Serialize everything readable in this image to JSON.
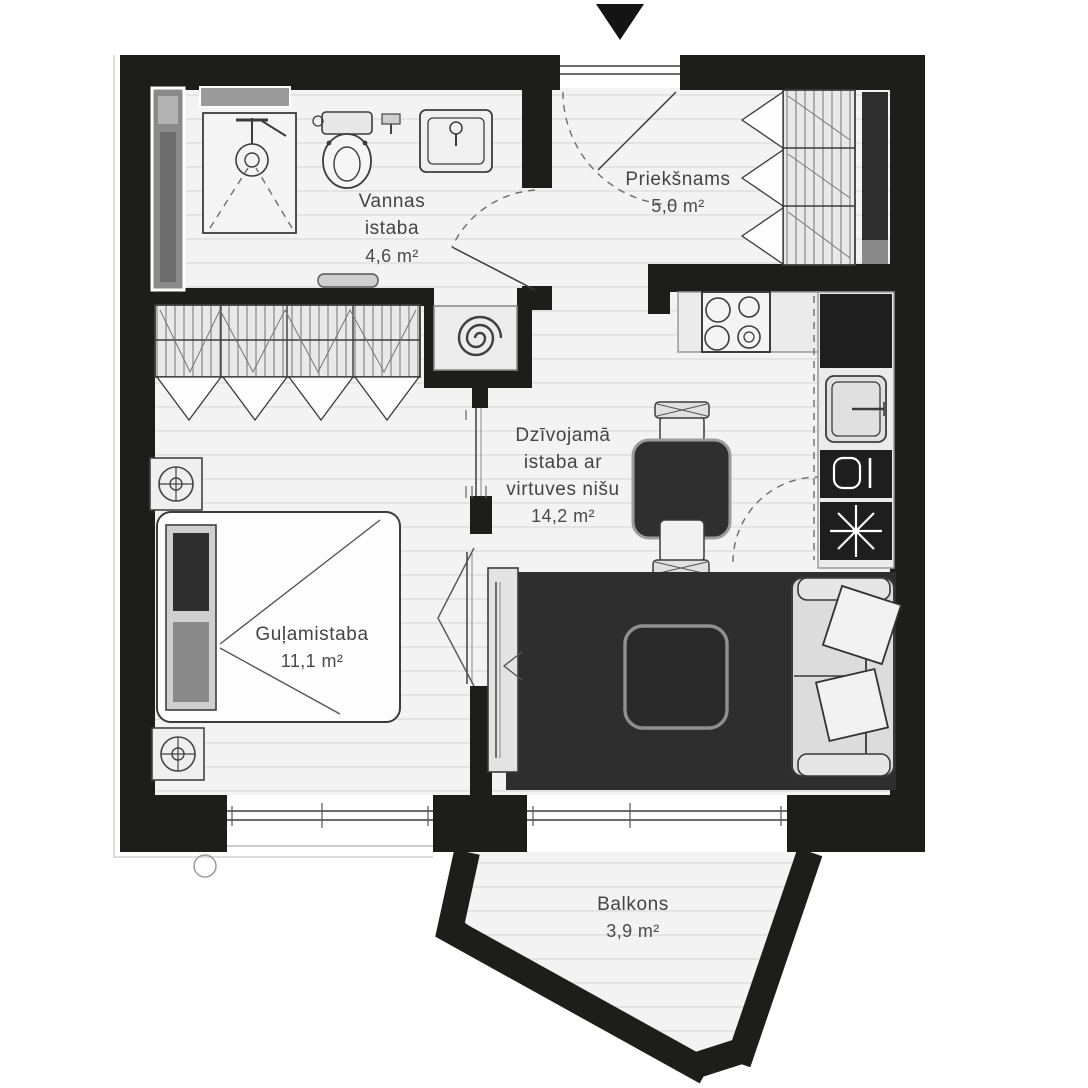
{
  "floorplan": {
    "rooms": {
      "bathroom": {
        "line1": "Vannas",
        "line2": "istaba",
        "area": "4,6 m²"
      },
      "hallway": {
        "name": "Priekšnams",
        "area": "5,0 m²"
      },
      "living_kitchen": {
        "line1": "Dzīvojamā",
        "line2": "istaba ar",
        "line3": "virtuves nišu",
        "area": "14,2 m²"
      },
      "bedroom": {
        "name": "Guļamistaba",
        "area": "11,1 m²"
      },
      "balcony": {
        "name": "Balkons",
        "area": "3,9 m²"
      }
    },
    "icons": {
      "entrance_arrow": "▼",
      "fixtures": [
        "shower",
        "toilet",
        "washbasin",
        "towel-rail",
        "heating-coil",
        "wardrobe",
        "hob",
        "kitchen-sink",
        "tall-cabinet",
        "boiler",
        "extract-fan",
        "dining-table",
        "chair",
        "tv-stand",
        "rug",
        "coffee-table",
        "sofa",
        "bed",
        "nightstand",
        "lamp",
        "radiator"
      ]
    },
    "colors": {
      "wall": "#1d1d1b",
      "floor": "#f3f3f3",
      "floor_line": "#e4e4e4",
      "furniture_light": "#ececec",
      "furniture_dark": "#2d2d2d",
      "outline": "#3c3c3c",
      "text": "#444444"
    }
  }
}
